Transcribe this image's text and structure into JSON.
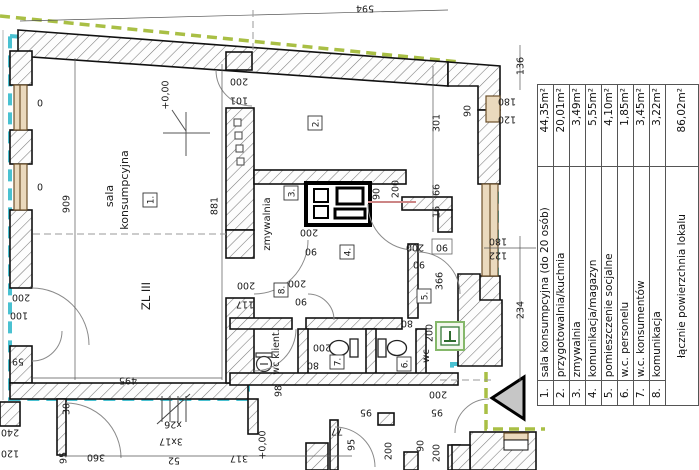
{
  "colors": {
    "unit_boundary_cyan": "#2ab6c9",
    "plot_boundary_green": "#a9bf45",
    "fire_zone_red": "#c0392b",
    "window_brown": "#6b4f2a",
    "opening_pink": "#cc8585"
  },
  "legend": {
    "rows": [
      {
        "num": "1.",
        "name": "sala konsumpcyjna (do 20 osób)",
        "area": "44,35m²"
      },
      {
        "num": "2.",
        "name": "przygotowalnia/kuchnia",
        "area": "20,01m²"
      },
      {
        "num": "3.",
        "name": "zmywalnia",
        "area": "3,49m²"
      },
      {
        "num": "4.",
        "name": "komunikacja/magazyn",
        "area": "5,55m²"
      },
      {
        "num": "5.",
        "name": "pomieszczenie socjalne",
        "area": "4,10m²"
      },
      {
        "num": "6.",
        "name": "w.c. personelu",
        "area": "1,85m²"
      },
      {
        "num": "7.",
        "name": "w.c. konsumentów",
        "area": "3,45m²"
      },
      {
        "num": "8.",
        "name": "komunikacja",
        "area": "3,22m²"
      }
    ],
    "total": {
      "name": "łącznie powierzchnia lokalu",
      "area": "86,02m²"
    }
  },
  "rooms": [
    "1.",
    "2.",
    "3.",
    "4.",
    "5.",
    "6.",
    "7.",
    "8."
  ],
  "labels": {
    "sala1": "sala",
    "sala2": "konsumpcyjna",
    "zmywalnia": "zmywalnia",
    "wc": "wc",
    "wc_klient": "wc klient.",
    "fire_zone": "ZL III"
  },
  "dims": [
    "594",
    "136",
    "180",
    "120",
    "90",
    "301",
    "200",
    "101",
    "909",
    "881",
    "+0,00",
    "66",
    "16",
    "90",
    "200",
    "200",
    "90",
    "200",
    "90",
    "200",
    "90",
    "180",
    "122",
    "366",
    "234",
    "80",
    "200",
    "200",
    "80",
    "200",
    "117",
    "98",
    "495",
    "59",
    "200",
    "100",
    "30",
    "95",
    "360",
    "52",
    "3x17",
    "x26",
    "317",
    "+0,00",
    "77",
    "95",
    "95",
    "200",
    "90",
    "200",
    "240",
    "120",
    "0",
    "0",
    "200",
    "95",
    "90"
  ]
}
